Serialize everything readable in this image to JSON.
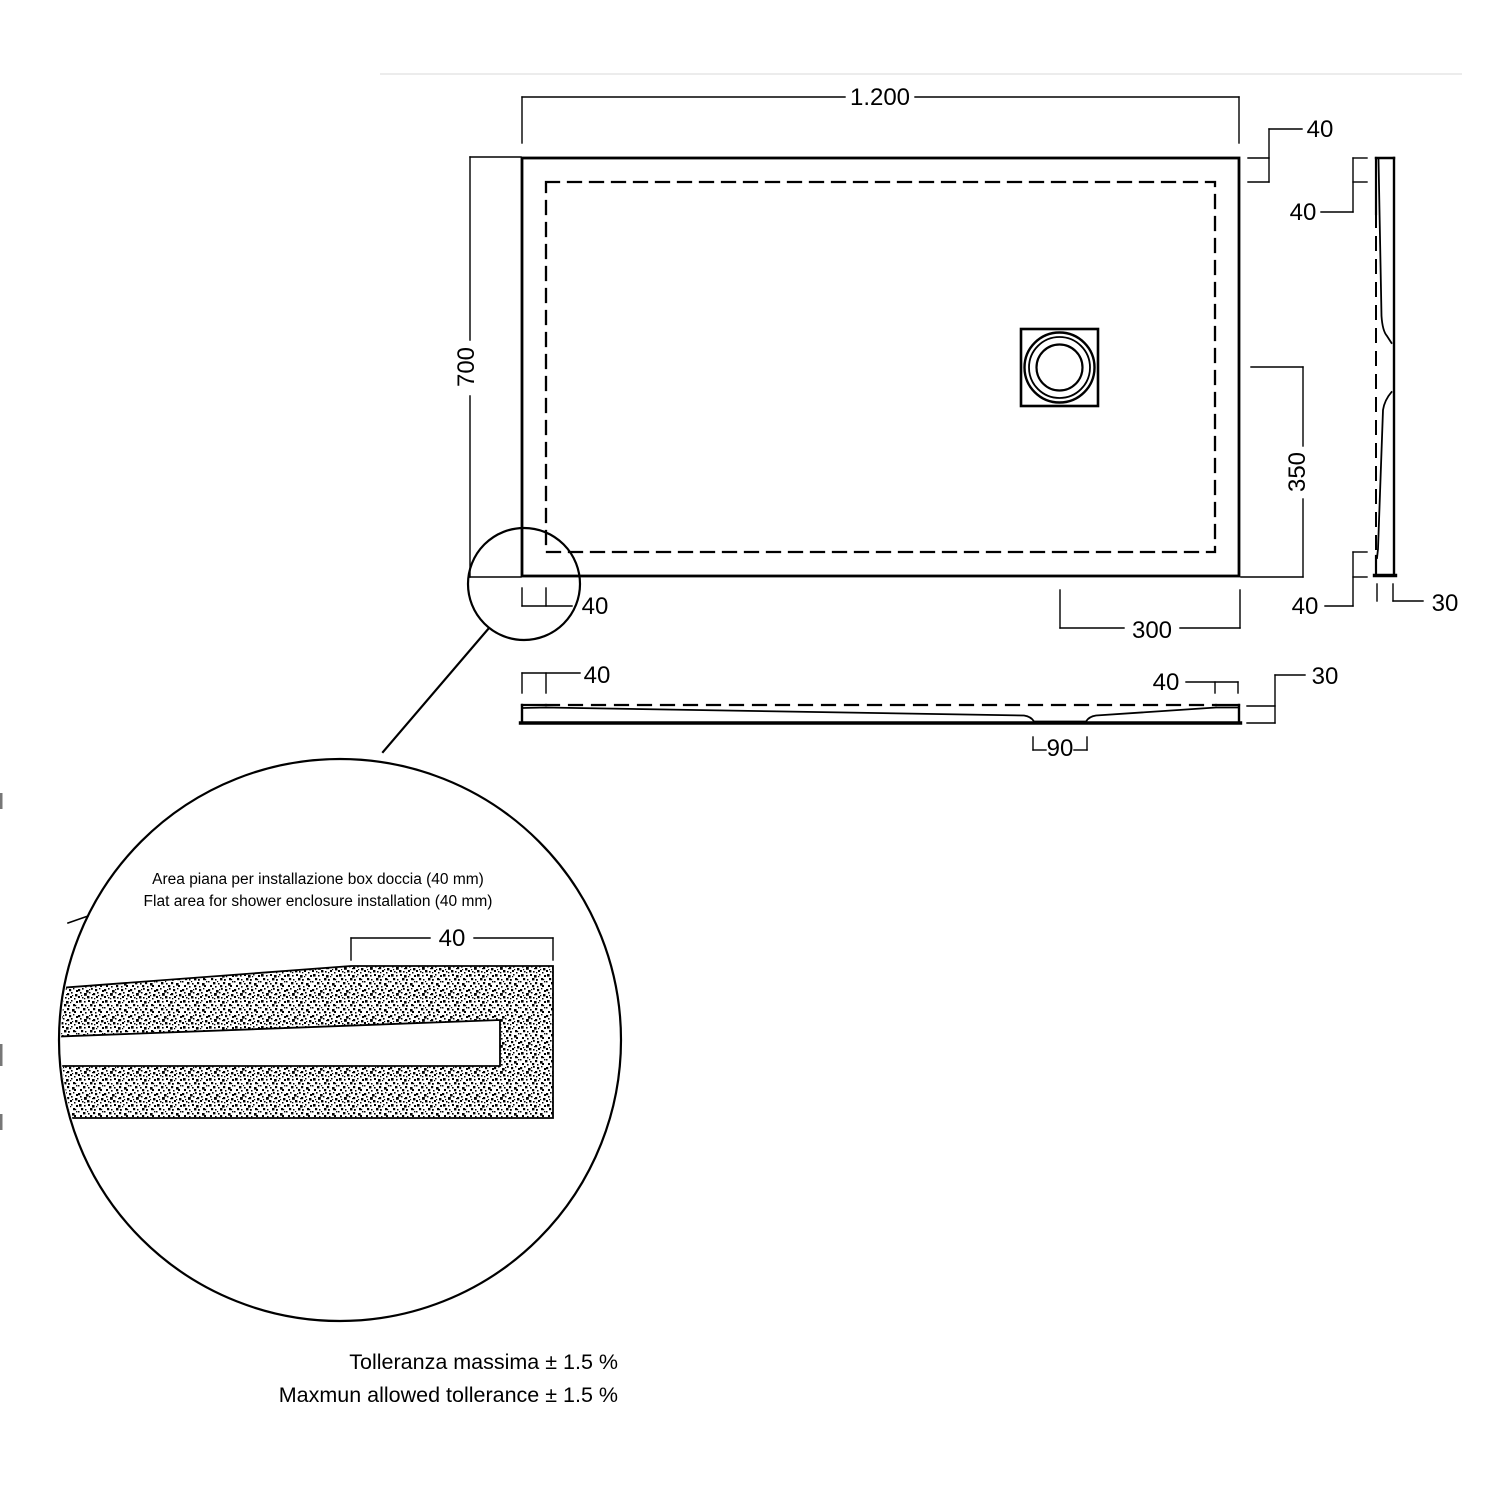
{
  "drawing": {
    "type": "shower-tray technical drawing",
    "line_color": "#000000",
    "background": "#ffffff"
  },
  "labels": {
    "total_width": "1.200",
    "flat_top_right": "40",
    "flat_side_top": "40",
    "total_depth": "700",
    "drain_to_edge": "350",
    "flat_corner": "40",
    "drain_to_right_edge": "300",
    "flat_side_bottom": "40",
    "side_thickness": "30",
    "flat_front_left": "40",
    "flat_front_right": "40",
    "front_thickness": "30",
    "drain_channel_width": "90",
    "detail_flat_width": "40"
  },
  "detail_note": {
    "it": "Area piana per installazione box doccia (40 mm)",
    "en": "Flat area for shower enclosure installation (40 mm)"
  },
  "tolerance_note": {
    "it": "Tolleranza massima ± 1.5 %",
    "en": "Maxmun allowed tollerance ± 1.5 %"
  }
}
